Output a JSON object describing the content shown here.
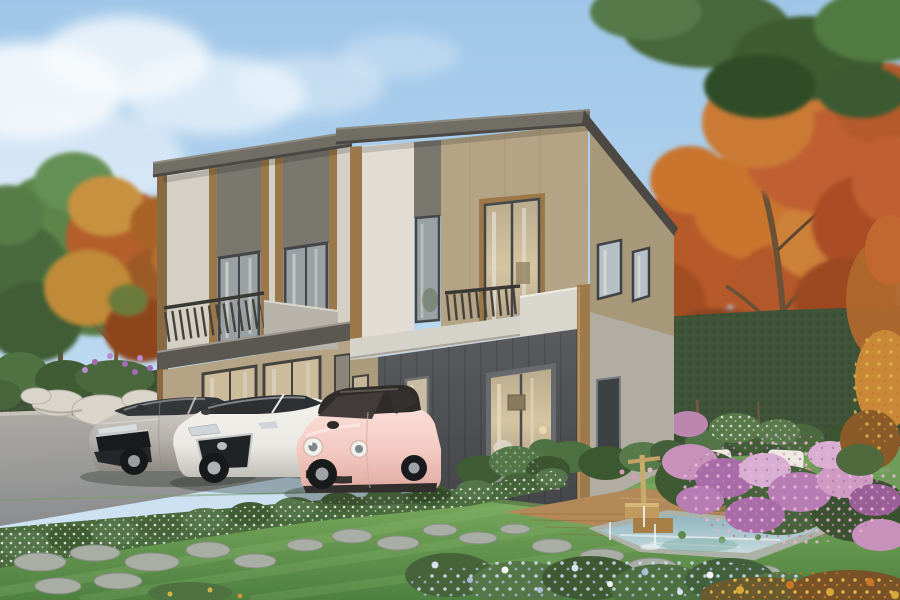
{
  "meta": {
    "type": "architectural-exterior-rendering",
    "width_px": 900,
    "height_px": 600
  },
  "scene": {
    "description": "Photorealistic rendering of a modern two-story duplex house with flat dark roofs, beige and charcoal facade panels, wood-tone trims and glass balconies. Three cars (silver hatchback, white hatchback, pink compact) are parked on the asphalt driveway. The landscaped garden has a green lawn with stepping stones, a flowering hedge, a wooden deck with two white armchairs and a side table, a small pond with a bamboo fountain, colorful flower beds, white rocks, green trees and orange autumn trees under a light blue sky.",
    "time_of_day": "day",
    "objects": [
      "sky with soft clouds",
      "green tree",
      "autumn orange trees",
      "dark green hedge wall",
      "two-story duplex house",
      "flat dark roof slabs",
      "balconies with metal railings",
      "brown wood trims",
      "charcoal ground-floor facade",
      "sliding glass door with warm interior light",
      "silver hatchback car",
      "white hatchback car",
      "pink compact car",
      "asphalt driveway",
      "white-flower hedge border",
      "lawn with stepping stones",
      "wooden deck",
      "two white armchairs and side table",
      "pond with bamboo fountain",
      "stone jar",
      "pink purple blue and yellow flower beds",
      "white garden rocks"
    ],
    "house": {
      "floors": 2,
      "units": 2,
      "cars_parked": 3
    }
  },
  "palette": {
    "sky_top": "#9fc6e8",
    "sky_mid": "#b8d7f0",
    "sky_bottom": "#d6e7f4",
    "cloud": "#f6fafd",
    "leaf_dark": "#3c5a31",
    "leaf_mid": "#54794a",
    "leaf_light": "#6f9a58",
    "autumn_dark": "#8f451f",
    "autumn_mid": "#b45f2a",
    "autumn_light": "#cd8038",
    "hedge_dark": "#3f5338",
    "hedge_light": "#5a7a4c",
    "lawn_dark": "#4e8040",
    "lawn_light": "#7fb061",
    "road_near": "#8e9093",
    "road_far": "#b2b0ab",
    "wall_greige": "#d4d0c6",
    "wall_white": "#e1ddd4",
    "wall_tan": "#b4a384",
    "wall_khaki": "#a69879",
    "wall_side": "#b2ada3",
    "panel_dark": "#7a776f",
    "charcoal": "#515255",
    "roof": "#716e66",
    "roof_edge": "#4c4944",
    "trim_brown": "#9b7849",
    "pillar_brown": "#9d7a4b",
    "slab_dark": "#5b5851",
    "slab_light": "#d5d2ca",
    "parapet": "#d9d6ce",
    "railing": "#45423b",
    "frame_dark": "#45464a",
    "glass_cool": "#9aa1a4",
    "glass_warm": "#cdbc9b",
    "curtain": "#e6e1d6",
    "car_silver": "#b7b3ac",
    "car_white": "#ebe9e4",
    "car_pink": "#f2c8bf",
    "car_roof_dark": "#2e2b28",
    "tire": "#1f2122",
    "deck_wood": "#b3895a",
    "deck_dark": "#8a6436",
    "pond_shallow": "#c6dadd",
    "pond_deep": "#8fb4bf",
    "stone": "#a9aea5",
    "rock_white": "#d9d5cb",
    "cushion": "#edeae1",
    "chair_wood": "#c2a577",
    "flower_pink": "#cf9ac4",
    "flower_purple": "#a469a8",
    "flower_blue": "#a8bcd8",
    "flower_yellow": "#d4a83c",
    "flower_white": "#f2f4f0",
    "jar": "#59636d",
    "fountain_wood": "#c5a166",
    "trunk": "#6e5740"
  }
}
